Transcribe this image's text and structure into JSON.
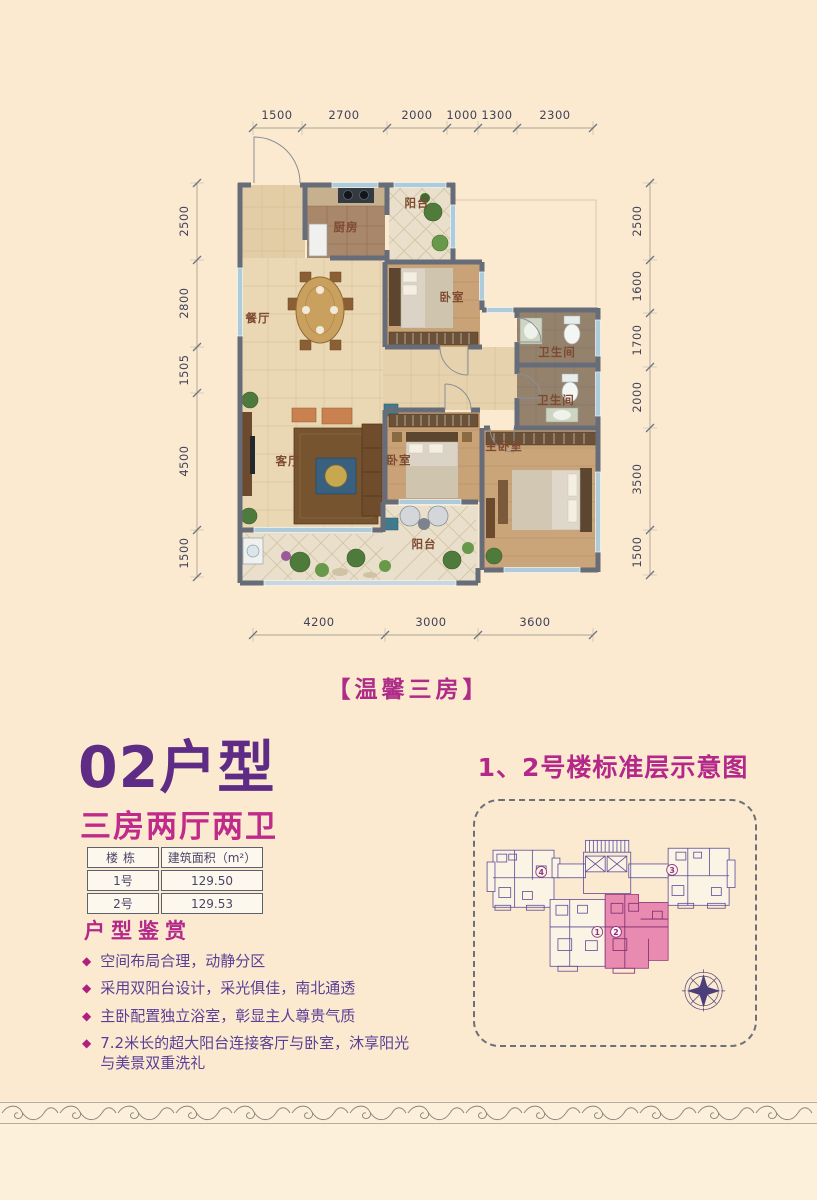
{
  "plan": {
    "title": "【温馨三房】",
    "dims_top": [
      "1500",
      "2700",
      "2000",
      "1000",
      "1300",
      "2300"
    ],
    "dims_left": [
      "2500",
      "2800",
      "1505",
      "4500",
      "1500"
    ],
    "dims_right": [
      "2500",
      "1600",
      "1700",
      "2000",
      "3500",
      "1500"
    ],
    "dims_bottom": [
      "4200",
      "3000",
      "3600"
    ],
    "rooms": {
      "kitchen": "厨房",
      "balcony_top": "阳台",
      "dining": "餐厅",
      "bedroom_a": "卧室",
      "bath_1": "卫生间",
      "bath_2": "卫生间",
      "living": "客厅",
      "bedroom_b": "卧室",
      "master": "主卧室",
      "balcony_bottom": "阳台"
    }
  },
  "unit": {
    "title": "02户型",
    "subtitle": "三房两厅两卫",
    "table": {
      "headers": [
        "楼栋",
        "建筑面积（m²）"
      ],
      "rows": [
        [
          "1号",
          "129.50"
        ],
        [
          "2号",
          "129.53"
        ]
      ]
    },
    "features_title": "户型鉴赏",
    "features": [
      "空间布局合理，动静分区",
      "采用双阳台设计，采光俱佳，南北通透",
      "主卧配置独立浴室，彰显主人尊贵气质",
      "7.2米长的超大阳台连接客厅与卧室，沐享阳光与美景双重洗礼"
    ]
  },
  "standard_floor": {
    "title": "1、2号楼标准层示意图",
    "units": [
      "4",
      "3",
      "1",
      "2"
    ]
  },
  "colors": {
    "background": "#fbead0",
    "accent_magenta": "#b4288a",
    "accent_purple": "#5e2c85",
    "highlight_pink": "#e98bb1",
    "wall": "#676c79"
  }
}
